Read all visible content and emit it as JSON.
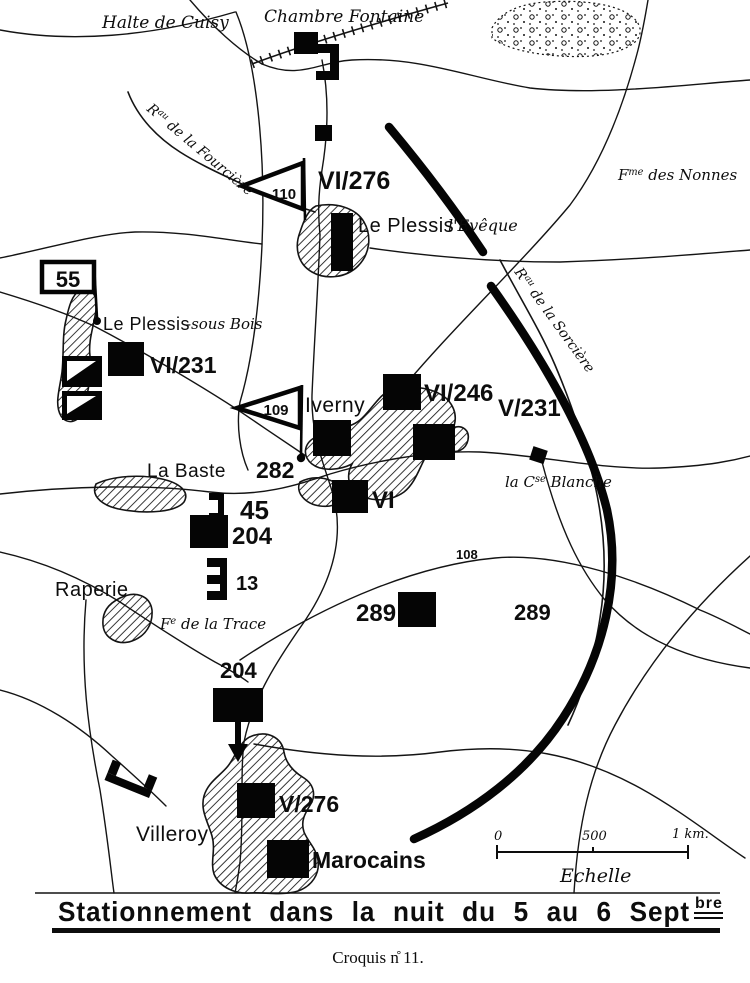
{
  "map": {
    "colors": {
      "ink": "#0d0d0d",
      "paper": "#ffffff"
    },
    "places": {
      "halte_de_cuisy": "Halte de Cuisy",
      "chambre_fontaine": "Chambre Fontaine",
      "ru_fourciere_prefix": "R",
      "ru_fourciere_sup": "au",
      "ru_fourciere_rest": " de la Fourcière",
      "fme_nonnes_prefix": "F",
      "fme_nonnes_sup": "me",
      "fme_nonnes_rest": " des Nonnes",
      "le_plessis_eveque_main": "Le Plessis",
      "le_plessis_eveque_suffix": "l'Evêque",
      "ru_sorciere_prefix": "R",
      "ru_sorciere_sup": "au",
      "ru_sorciere_rest": " de la Sorcière",
      "le_plessis_sous_bois_main": "Le Plessis",
      "le_plessis_sous_bois_suffix": "-sous Bois",
      "iverny": "Iverny",
      "la_baste": "La Baste",
      "cse_blanche_prefix": "la C",
      "cse_blanche_sup": "se",
      "cse_blanche_rest": " Blanche",
      "raperie": "Raperie",
      "fe_trace_prefix": "F",
      "fe_trace_sup": "e",
      "fe_trace_rest": " de la Trace",
      "villeroy": "Villeroy"
    },
    "units": {
      "vi276": "VI/276",
      "flag110": "110",
      "flag55": "55",
      "vi231": "VI/231",
      "flag109": "109",
      "vi246": "VI/246",
      "v231": "V/231",
      "n282": "282",
      "vi": "VI",
      "n45": "45",
      "n204_center": "204",
      "n13": "13",
      "n289_west": "289",
      "n289_east": "289",
      "n108": "108",
      "n204_south": "204",
      "v276": "V/276",
      "marocains": "Marocains"
    },
    "scale": {
      "tick0": "0",
      "tick500": "500",
      "tick1km": "1 km.",
      "label": "Echelle"
    }
  },
  "footer": {
    "title_main": "Stationnement dans la nuit du 5 au 6 Sept",
    "title_sup": "bre",
    "caption": "Croquis n̊ 11."
  }
}
